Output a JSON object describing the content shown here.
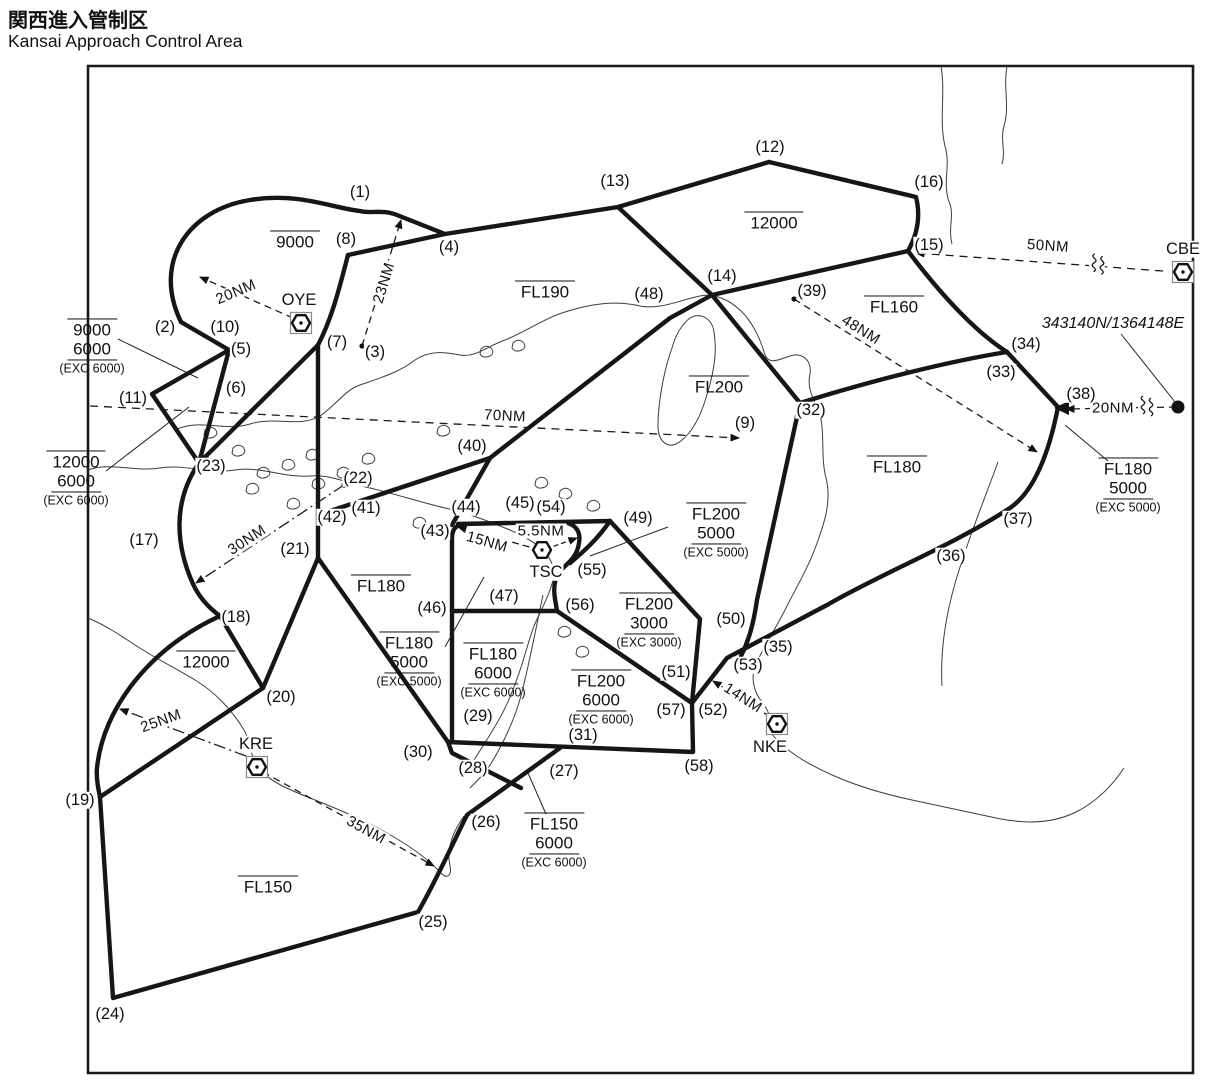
{
  "title": {
    "jp": "関西進入管制区",
    "en": "Kansai Approach Control Area"
  },
  "colors": {
    "ink": "#161616",
    "coast": "#3d3d3d",
    "background": "#ffffff"
  },
  "map": {
    "frame": {
      "d": "M 88 66 H 1193 V 1073 H 88 Z"
    },
    "points": [
      {
        "label": "(1)",
        "x": 360,
        "y": 192
      },
      {
        "label": "(2)",
        "x": 165,
        "y": 327
      },
      {
        "label": "(3)",
        "x": 375,
        "y": 352
      },
      {
        "label": "(4)",
        "x": 449,
        "y": 247
      },
      {
        "label": "(5)",
        "x": 241,
        "y": 349
      },
      {
        "label": "(6)",
        "x": 236,
        "y": 388
      },
      {
        "label": "(7)",
        "x": 337,
        "y": 342
      },
      {
        "label": "(8)",
        "x": 346,
        "y": 239
      },
      {
        "label": "(9)",
        "x": 745,
        "y": 423
      },
      {
        "label": "(10)",
        "x": 225,
        "y": 327
      },
      {
        "label": "(11)",
        "x": 133,
        "y": 398
      },
      {
        "label": "(12)",
        "x": 770,
        "y": 147
      },
      {
        "label": "(13)",
        "x": 615,
        "y": 181
      },
      {
        "label": "(14)",
        "x": 722,
        "y": 276
      },
      {
        "label": "(15)",
        "x": 929,
        "y": 245
      },
      {
        "label": "(16)",
        "x": 929,
        "y": 182
      },
      {
        "label": "(17)",
        "x": 144,
        "y": 540
      },
      {
        "label": "(18)",
        "x": 236,
        "y": 617
      },
      {
        "label": "(19)",
        "x": 80,
        "y": 800
      },
      {
        "label": "(20)",
        "x": 281,
        "y": 697
      },
      {
        "label": "(21)",
        "x": 295,
        "y": 549
      },
      {
        "label": "(22)",
        "x": 358,
        "y": 478
      },
      {
        "label": "(23)",
        "x": 211,
        "y": 466
      },
      {
        "label": "(24)",
        "x": 110,
        "y": 1014
      },
      {
        "label": "(25)",
        "x": 433,
        "y": 922
      },
      {
        "label": "(26)",
        "x": 486,
        "y": 822
      },
      {
        "label": "(27)",
        "x": 564,
        "y": 771
      },
      {
        "label": "(28)",
        "x": 473,
        "y": 768
      },
      {
        "label": "(29)",
        "x": 478,
        "y": 716
      },
      {
        "label": "(30)",
        "x": 418,
        "y": 752
      },
      {
        "label": "(31)",
        "x": 583,
        "y": 735
      },
      {
        "label": "(32)",
        "x": 811,
        "y": 410
      },
      {
        "label": "(33)",
        "x": 1001,
        "y": 372
      },
      {
        "label": "(34)",
        "x": 1026,
        "y": 344
      },
      {
        "label": "(35)",
        "x": 778,
        "y": 647
      },
      {
        "label": "(36)",
        "x": 951,
        "y": 556
      },
      {
        "label": "(37)",
        "x": 1018,
        "y": 519
      },
      {
        "label": "(38)",
        "x": 1081,
        "y": 394
      },
      {
        "label": "(39)",
        "x": 812,
        "y": 291
      },
      {
        "label": "(40)",
        "x": 472,
        "y": 446
      },
      {
        "label": "(41)",
        "x": 366,
        "y": 508
      },
      {
        "label": "(42)",
        "x": 332,
        "y": 517
      },
      {
        "label": "(43)",
        "x": 435,
        "y": 531
      },
      {
        "label": "(44)",
        "x": 466,
        "y": 507
      },
      {
        "label": "(45)",
        "x": 520,
        "y": 503
      },
      {
        "label": "(46)",
        "x": 432,
        "y": 608
      },
      {
        "label": "(47)",
        "x": 504,
        "y": 596
      },
      {
        "label": "(48)",
        "x": 649,
        "y": 294
      },
      {
        "label": "(49)",
        "x": 638,
        "y": 518
      },
      {
        "label": "(50)",
        "x": 731,
        "y": 619
      },
      {
        "label": "(51)",
        "x": 676,
        "y": 672
      },
      {
        "label": "(52)",
        "x": 713,
        "y": 710
      },
      {
        "label": "(53)",
        "x": 748,
        "y": 665
      },
      {
        "label": "(54)",
        "x": 551,
        "y": 507
      },
      {
        "label": "(55)",
        "x": 592,
        "y": 570
      },
      {
        "label": "(56)",
        "x": 580,
        "y": 605
      },
      {
        "label": "(57)",
        "x": 671,
        "y": 710
      },
      {
        "label": "(58)",
        "x": 699,
        "y": 766
      }
    ],
    "region_labels": [
      {
        "x": 295,
        "y": 241,
        "lines": [
          {
            "t": "9000",
            "s": "over"
          }
        ]
      },
      {
        "x": 92,
        "y": 347,
        "lines": [
          {
            "t": "9000",
            "s": "over"
          },
          {
            "t": "6000",
            "s": "under"
          },
          {
            "t": "(EXC 6000)",
            "s": "small"
          }
        ]
      },
      {
        "x": 76,
        "y": 479,
        "lines": [
          {
            "t": "12000",
            "s": "over"
          },
          {
            "t": "6000",
            "s": "under"
          },
          {
            "t": "(EXC 6000)",
            "s": "small"
          }
        ]
      },
      {
        "x": 545,
        "y": 291,
        "lines": [
          {
            "t": "FL190",
            "s": "over"
          }
        ]
      },
      {
        "x": 774,
        "y": 222,
        "lines": [
          {
            "t": "12000",
            "s": "over"
          }
        ]
      },
      {
        "x": 894,
        "y": 306,
        "lines": [
          {
            "t": "FL160",
            "s": "over"
          }
        ]
      },
      {
        "x": 719,
        "y": 386,
        "lines": [
          {
            "t": "FL200",
            "s": "over"
          }
        ]
      },
      {
        "x": 897,
        "y": 466,
        "lines": [
          {
            "t": "FL180",
            "s": "over"
          }
        ]
      },
      {
        "x": 381,
        "y": 585,
        "lines": [
          {
            "t": "FL180",
            "s": "over"
          }
        ]
      },
      {
        "x": 206,
        "y": 661,
        "lines": [
          {
            "t": "12000",
            "s": "over"
          }
        ]
      },
      {
        "x": 268,
        "y": 886,
        "lines": [
          {
            "t": "FL150",
            "s": "over"
          }
        ]
      },
      {
        "x": 1128,
        "y": 486,
        "lines": [
          {
            "t": "FL180",
            "s": "over"
          },
          {
            "t": "5000",
            "s": "under"
          },
          {
            "t": "(EXC 5000)",
            "s": "small"
          }
        ]
      },
      {
        "x": 716,
        "y": 531,
        "lines": [
          {
            "t": "FL200",
            "s": "over"
          },
          {
            "t": "5000",
            "s": "under"
          },
          {
            "t": "(EXC 5000)",
            "s": "small"
          }
        ]
      },
      {
        "x": 649,
        "y": 621,
        "lines": [
          {
            "t": "FL200",
            "s": "over"
          },
          {
            "t": "3000",
            "s": "under"
          },
          {
            "t": "(EXC 3000)",
            "s": "small"
          }
        ]
      },
      {
        "x": 409,
        "y": 660,
        "lines": [
          {
            "t": "FL180",
            "s": "over"
          },
          {
            "t": "5000",
            "s": "under"
          },
          {
            "t": "(EXC 5000)",
            "s": "small"
          }
        ]
      },
      {
        "x": 493,
        "y": 671,
        "lines": [
          {
            "t": "FL180",
            "s": "over"
          },
          {
            "t": "6000",
            "s": "under"
          },
          {
            "t": "(EXC 6000)",
            "s": "small"
          }
        ]
      },
      {
        "x": 601,
        "y": 698,
        "lines": [
          {
            "t": "FL200",
            "s": "over"
          },
          {
            "t": "6000",
            "s": "under"
          },
          {
            "t": "(EXC 6000)",
            "s": "small"
          }
        ]
      },
      {
        "x": 554,
        "y": 841,
        "lines": [
          {
            "t": "FL150",
            "s": "over"
          },
          {
            "t": "6000",
            "s": "under"
          },
          {
            "t": "(EXC 6000)",
            "s": "small"
          }
        ]
      }
    ],
    "navaids": [
      {
        "id": "OYE",
        "x": 301,
        "y": 323,
        "lx": 299,
        "ly": 300,
        "boxed": true
      },
      {
        "id": "CBE",
        "x": 1183,
        "y": 272,
        "lx": 1183,
        "ly": 249,
        "boxed": true
      },
      {
        "id": "KRE",
        "x": 257,
        "y": 767,
        "lx": 256,
        "ly": 744,
        "boxed": true
      },
      {
        "id": "NKE",
        "x": 777,
        "y": 724,
        "lx": 770,
        "ly": 747,
        "boxed": true
      },
      {
        "id": "TSC",
        "x": 542,
        "y": 550,
        "lx": 546,
        "ly": 572,
        "boxed": false
      }
    ],
    "coordinate_note": {
      "text": "343140N/1364148E",
      "x": 1113,
      "y": 324
    },
    "distances": [
      {
        "label": "20NM",
        "x": 236,
        "y": 292,
        "rot": -23,
        "d": "M 293 318 L 200 277",
        "dash": "7 5"
      },
      {
        "label": "23NM",
        "x": 384,
        "y": 283,
        "rot": -73,
        "d": "M 362 346 L 401 220",
        "dash": "7 5",
        "dot": true
      },
      {
        "label": "50NM",
        "x": 1048,
        "y": 246,
        "rot": 4,
        "d": "M 1163 271 L 916 253",
        "dash": "8 6",
        "squiggle": {
          "x": 1097,
          "y": 265,
          "rot": 4
        }
      },
      {
        "label": "70NM",
        "x": 505,
        "y": 416,
        "rot": 3,
        "d": "M 90 406 L 739 438",
        "dash": "8 6"
      },
      {
        "label": "30NM",
        "x": 247,
        "y": 540,
        "rot": -33,
        "d": "M 344 485 L 196 583",
        "dash": "12 4 2 4",
        "dot": true
      },
      {
        "label": "48NM",
        "x": 861,
        "y": 330,
        "rot": 32,
        "d": "M 794 299 L 1037 452",
        "dash": "7 5",
        "dot": true
      },
      {
        "label": "25NM",
        "x": 161,
        "y": 721,
        "rot": -20,
        "d": "M 246 756 L 120 709",
        "dash": "12 4 2 4"
      },
      {
        "label": "35NM",
        "x": 366,
        "y": 830,
        "rot": 29,
        "d": "M 263 772 L 434 866",
        "dash": "7 5"
      },
      {
        "label": "14NM",
        "x": 743,
        "y": 698,
        "rot": 33,
        "d": "M 769 716 L 713 681",
        "dash": "6 4"
      },
      {
        "label": "20NM",
        "x": 1113,
        "y": 408,
        "rot": 0,
        "d": "M 1176 407 L 1066 409",
        "dash": "7 5",
        "squiggle": {
          "x": 1146,
          "y": 407,
          "rot": 0
        },
        "big_dot": {
          "x": 1178,
          "y": 407
        }
      },
      {
        "label": "5.5NM",
        "x": 541,
        "y": 531,
        "rot": 0,
        "d": "M 546 549 L 577 538",
        "dash": "5 3"
      },
      {
        "label": "15NM",
        "x": 487,
        "y": 542,
        "rot": 16,
        "d": "M 540 550 L 458 527",
        "dash": "7 4"
      }
    ],
    "boundaries": [
      {
        "name": "arc-9000",
        "d": "M 181 322 C 152 262 188 210 250 200 C 298 192 332 208 360 211 C 371 214 382 209 397 215 L 445 234"
      },
      {
        "name": "north-line-8-12",
        "d": "M 348 255 L 445 234 L 618 207 L 769 162"
      },
      {
        "name": "line-12-15",
        "d": "M 769 162 L 916 197 C 921 217 917 235 908 251"
      },
      {
        "name": "line-15-34",
        "d": "M 908 251 C 938 291 974 331 1007 352"
      },
      {
        "name": "line-13-32",
        "d": "M 618 207 L 712 295 L 800 403"
      },
      {
        "name": "line-48-15",
        "d": "M 670 318 L 712 295 L 908 251"
      },
      {
        "name": "diag-48-42",
        "d": "M 670 318 L 490 458 L 318 515"
      },
      {
        "name": "line-8-42",
        "d": "M 348 255 C 337 298 330 322 318 345 L 318 515"
      },
      {
        "name": "line-oye-23",
        "d": "M 318 345 L 199 463"
      },
      {
        "name": "pocket-nw",
        "d": "M 181 322 L 229 350 L 152 394 L 199 463"
      },
      {
        "name": "pocket-nw2",
        "d": "M 229 350 L 199 463"
      },
      {
        "name": "west-arc-23-18",
        "d": "M 199 463 C 172 502 176 546 193 584 C 199 597 209 608 220 616"
      },
      {
        "name": "chords-18-20-19",
        "d": "M 220 616 L 263 688 L 100 797"
      },
      {
        "name": "west-arc-18-19",
        "d": "M 220 616 C 150 648 103 708 97 768 C 96 778 98 788 100 797"
      },
      {
        "name": "southwest-19-24-27",
        "d": "M 100 797 L 113 998 L 418 912 C 437 879 452 845 467 815 L 560 748"
      },
      {
        "name": "line-42-21-20",
        "d": "M 318 515 L 318 558 L 263 688"
      },
      {
        "name": "line-21-30",
        "d": "M 318 558 L 448 742"
      },
      {
        "name": "line-40-43",
        "d": "M 490 458 L 452 525"
      },
      {
        "name": "box-left",
        "d": "M 466 524 Q 452 524 452 538 L 452 742"
      },
      {
        "name": "box-top",
        "d": "M 458 524 L 610 521"
      },
      {
        "name": "tsc-pocket",
        "d": "M 563 522 C 577 524 581 533 579 543 C 577 557 569 562 562 569 C 555 576 553 587 555 599 L 557 611"
      },
      {
        "name": "line-49-55",
        "d": "M 610 521 C 597 540 582 553 570 563"
      },
      {
        "name": "line-46-56",
        "d": "M 452 611 L 557 611"
      },
      {
        "name": "line-56-junction",
        "d": "M 557 611 L 692 703"
      },
      {
        "name": "line-49-50",
        "d": "M 610 521 L 700 619 L 692 703"
      },
      {
        "name": "line-32-junction",
        "d": "M 800 403 L 757 600 C 753 627 748 642 741 656"
      },
      {
        "name": "line-32-34",
        "d": "M 800 403 C 870 381 950 361 1007 352"
      },
      {
        "name": "line-34-38-35",
        "d": "M 1007 352 L 1058 407 C 1050 448 1036 490 1010 508 C 952 546 880 574 827 605 L 727 658 L 692 703"
      },
      {
        "name": "box-bottom-58",
        "d": "M 692 703 L 693 752 L 448 742"
      },
      {
        "name": "spur-30",
        "d": "M 448 742 L 452 753 L 521 788"
      }
    ],
    "coastlines": [
      {
        "d": "M 175 430 C 200 418 225 432 250 424 C 275 416 300 428 320 416 C 335 406 345 390 360 385 C 380 378 400 372 415 360 C 430 350 445 352 460 355 C 475 358 490 345 505 340 C 525 332 545 318 565 312 C 590 304 615 300 640 306 C 660 310 680 300 700 296 C 715 293 730 300 742 312 C 752 322 760 338 764 352 C 768 366 778 360 790 356 C 802 352 812 360 810 374 C 807 386 812 398 818 408"
      },
      {
        "d": "M 690 318 C 700 312 712 318 714 332 C 718 356 712 380 704 404 C 698 422 688 438 676 444 C 666 448 658 440 658 426 C 658 402 664 370 672 348 C 676 334 682 324 690 318 Z"
      },
      {
        "d": "M 88 470 C 110 462 135 472 160 468 C 185 464 210 474 235 470 C 260 466 285 478 310 476 C 330 474 350 484 370 488 C 395 494 420 502 445 508 C 465 512 485 520 505 528 C 520 534 535 542 545 552 C 552 560 556 572 552 584 C 548 598 540 612 534 626 C 528 642 524 660 518 676 C 512 694 504 712 494 728 C 486 742 476 756 468 770"
      },
      {
        "d": "M 88 618 C 105 625 120 635 135 645 C 155 658 175 668 195 680 C 215 692 232 710 244 730 C 252 744 250 758 258 768 C 270 782 290 790 310 798 C 335 808 360 818 385 832 C 405 843 425 856 440 872 C 447 880 452 876 450 866 C 446 848 454 830 464 816"
      },
      {
        "d": "M 818 408 C 826 430 820 455 826 478 C 832 502 824 524 816 546 C 808 568 796 588 786 608 C 776 628 764 646 756 664 C 750 678 754 692 762 702 C 770 712 772 722 770 732 C 786 752 808 764 830 774 C 856 786 884 794 912 800 C 940 806 968 812 996 818 C 1024 824 1052 824 1076 812 C 1096 802 1112 786 1124 768"
      },
      {
        "d": "M 998 462 C 984 500 968 540 956 580 C 946 614 940 650 942 686"
      },
      {
        "d": "M 941 66 C 946 96 938 122 946 150 C 950 168 942 186 950 204 C 954 216 948 230 952 244"
      },
      {
        "d": "M 1007 66 C 1003 88 1010 106 1004 126 C 1000 140 1006 152 1002 164"
      },
      {
        "d": "M 543 595 C 536 628 530 660 522 692 C 516 716 505 740 492 762 C 486 772 478 780 470 788"
      }
    ],
    "islands": [
      [
        205,
        430
      ],
      [
        233,
        448
      ],
      [
        198,
        458
      ],
      [
        258,
        470
      ],
      [
        283,
        462
      ],
      [
        307,
        452
      ],
      [
        247,
        486
      ],
      [
        313,
        481
      ],
      [
        338,
        470
      ],
      [
        363,
        456
      ],
      [
        481,
        349
      ],
      [
        513,
        343
      ],
      [
        438,
        428
      ],
      [
        559,
        629
      ],
      [
        577,
        649
      ],
      [
        560,
        491
      ],
      [
        588,
        503
      ],
      [
        288,
        501
      ],
      [
        414,
        520
      ],
      [
        536,
        480
      ]
    ],
    "leaders": [
      {
        "d": "M 118 339 L 198 378"
      },
      {
        "d": "M 106 471 L 189 407"
      },
      {
        "d": "M 1121 334 L 1175 402"
      },
      {
        "d": "M 1108 461 L 1065 425"
      },
      {
        "d": "M 668 527 L 590 556"
      },
      {
        "d": "M 445 647 L 484 577"
      },
      {
        "d": "M 546 814 L 528 773"
      }
    ],
    "extra_marks": {
      "notch": {
        "points": "1054,408 1069,401 1069,415"
      }
    }
  }
}
